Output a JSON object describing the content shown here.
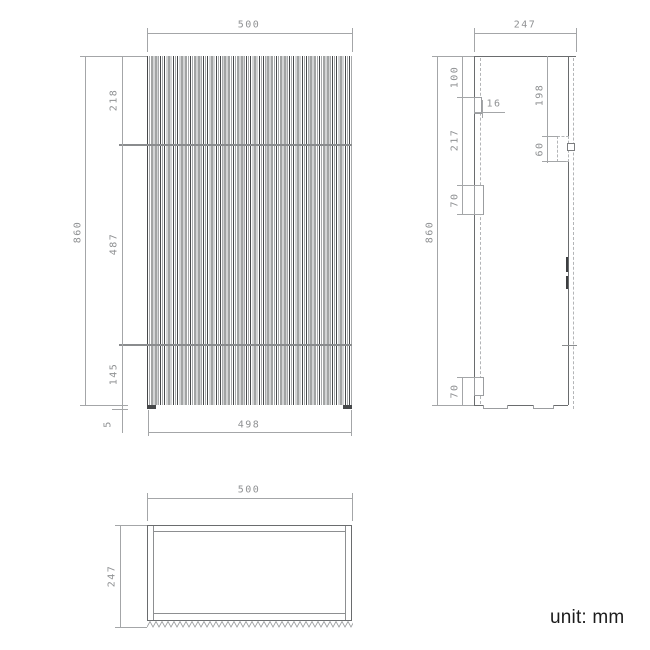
{
  "unit_label": "unit: mm",
  "colors": {
    "outline": "#6a6c6e",
    "dimension": "#a4a6a8",
    "dimension_text": "#8f9193",
    "flute_dark": "#46484a",
    "flute_light": "#a7a9ab",
    "unit_text": "#1b1b1b"
  },
  "front_view": {
    "width_top": "500",
    "height_total": "860",
    "seg_top": "218",
    "seg_mid": "487",
    "seg_bottom": "145",
    "plinth": "5",
    "width_bottom": "498"
  },
  "side_view": {
    "depth_top": "247",
    "height_total": "860",
    "top_offset": "100",
    "rail_thickness": "16",
    "mid_span": "217",
    "bracket_height": "70",
    "back_offset": "198",
    "slot_height": "60",
    "bottom_offset": "70"
  },
  "top_view": {
    "width": "500",
    "depth": "247"
  }
}
